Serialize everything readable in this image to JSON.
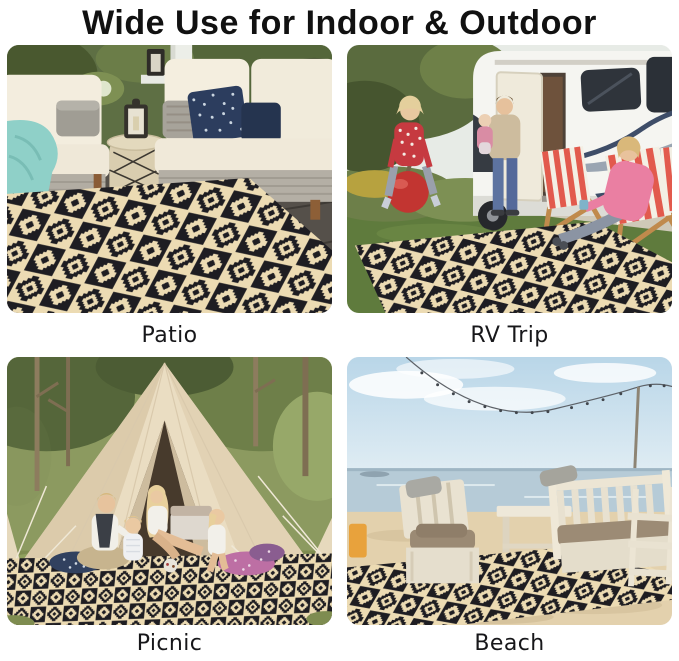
{
  "title": "Wide Use for Indoor & Outdoor",
  "scenes": [
    {
      "id": "patio",
      "label": "Patio"
    },
    {
      "id": "rv-trip",
      "label": "RV Trip"
    },
    {
      "id": "picnic",
      "label": "Picnic"
    },
    {
      "id": "beach",
      "label": "Beach"
    }
  ],
  "colors": {
    "rug_black": "#1e1d22",
    "rug_cream": "#ecdbb3",
    "title_color": "#111111",
    "caption_color": "#17171a"
  }
}
